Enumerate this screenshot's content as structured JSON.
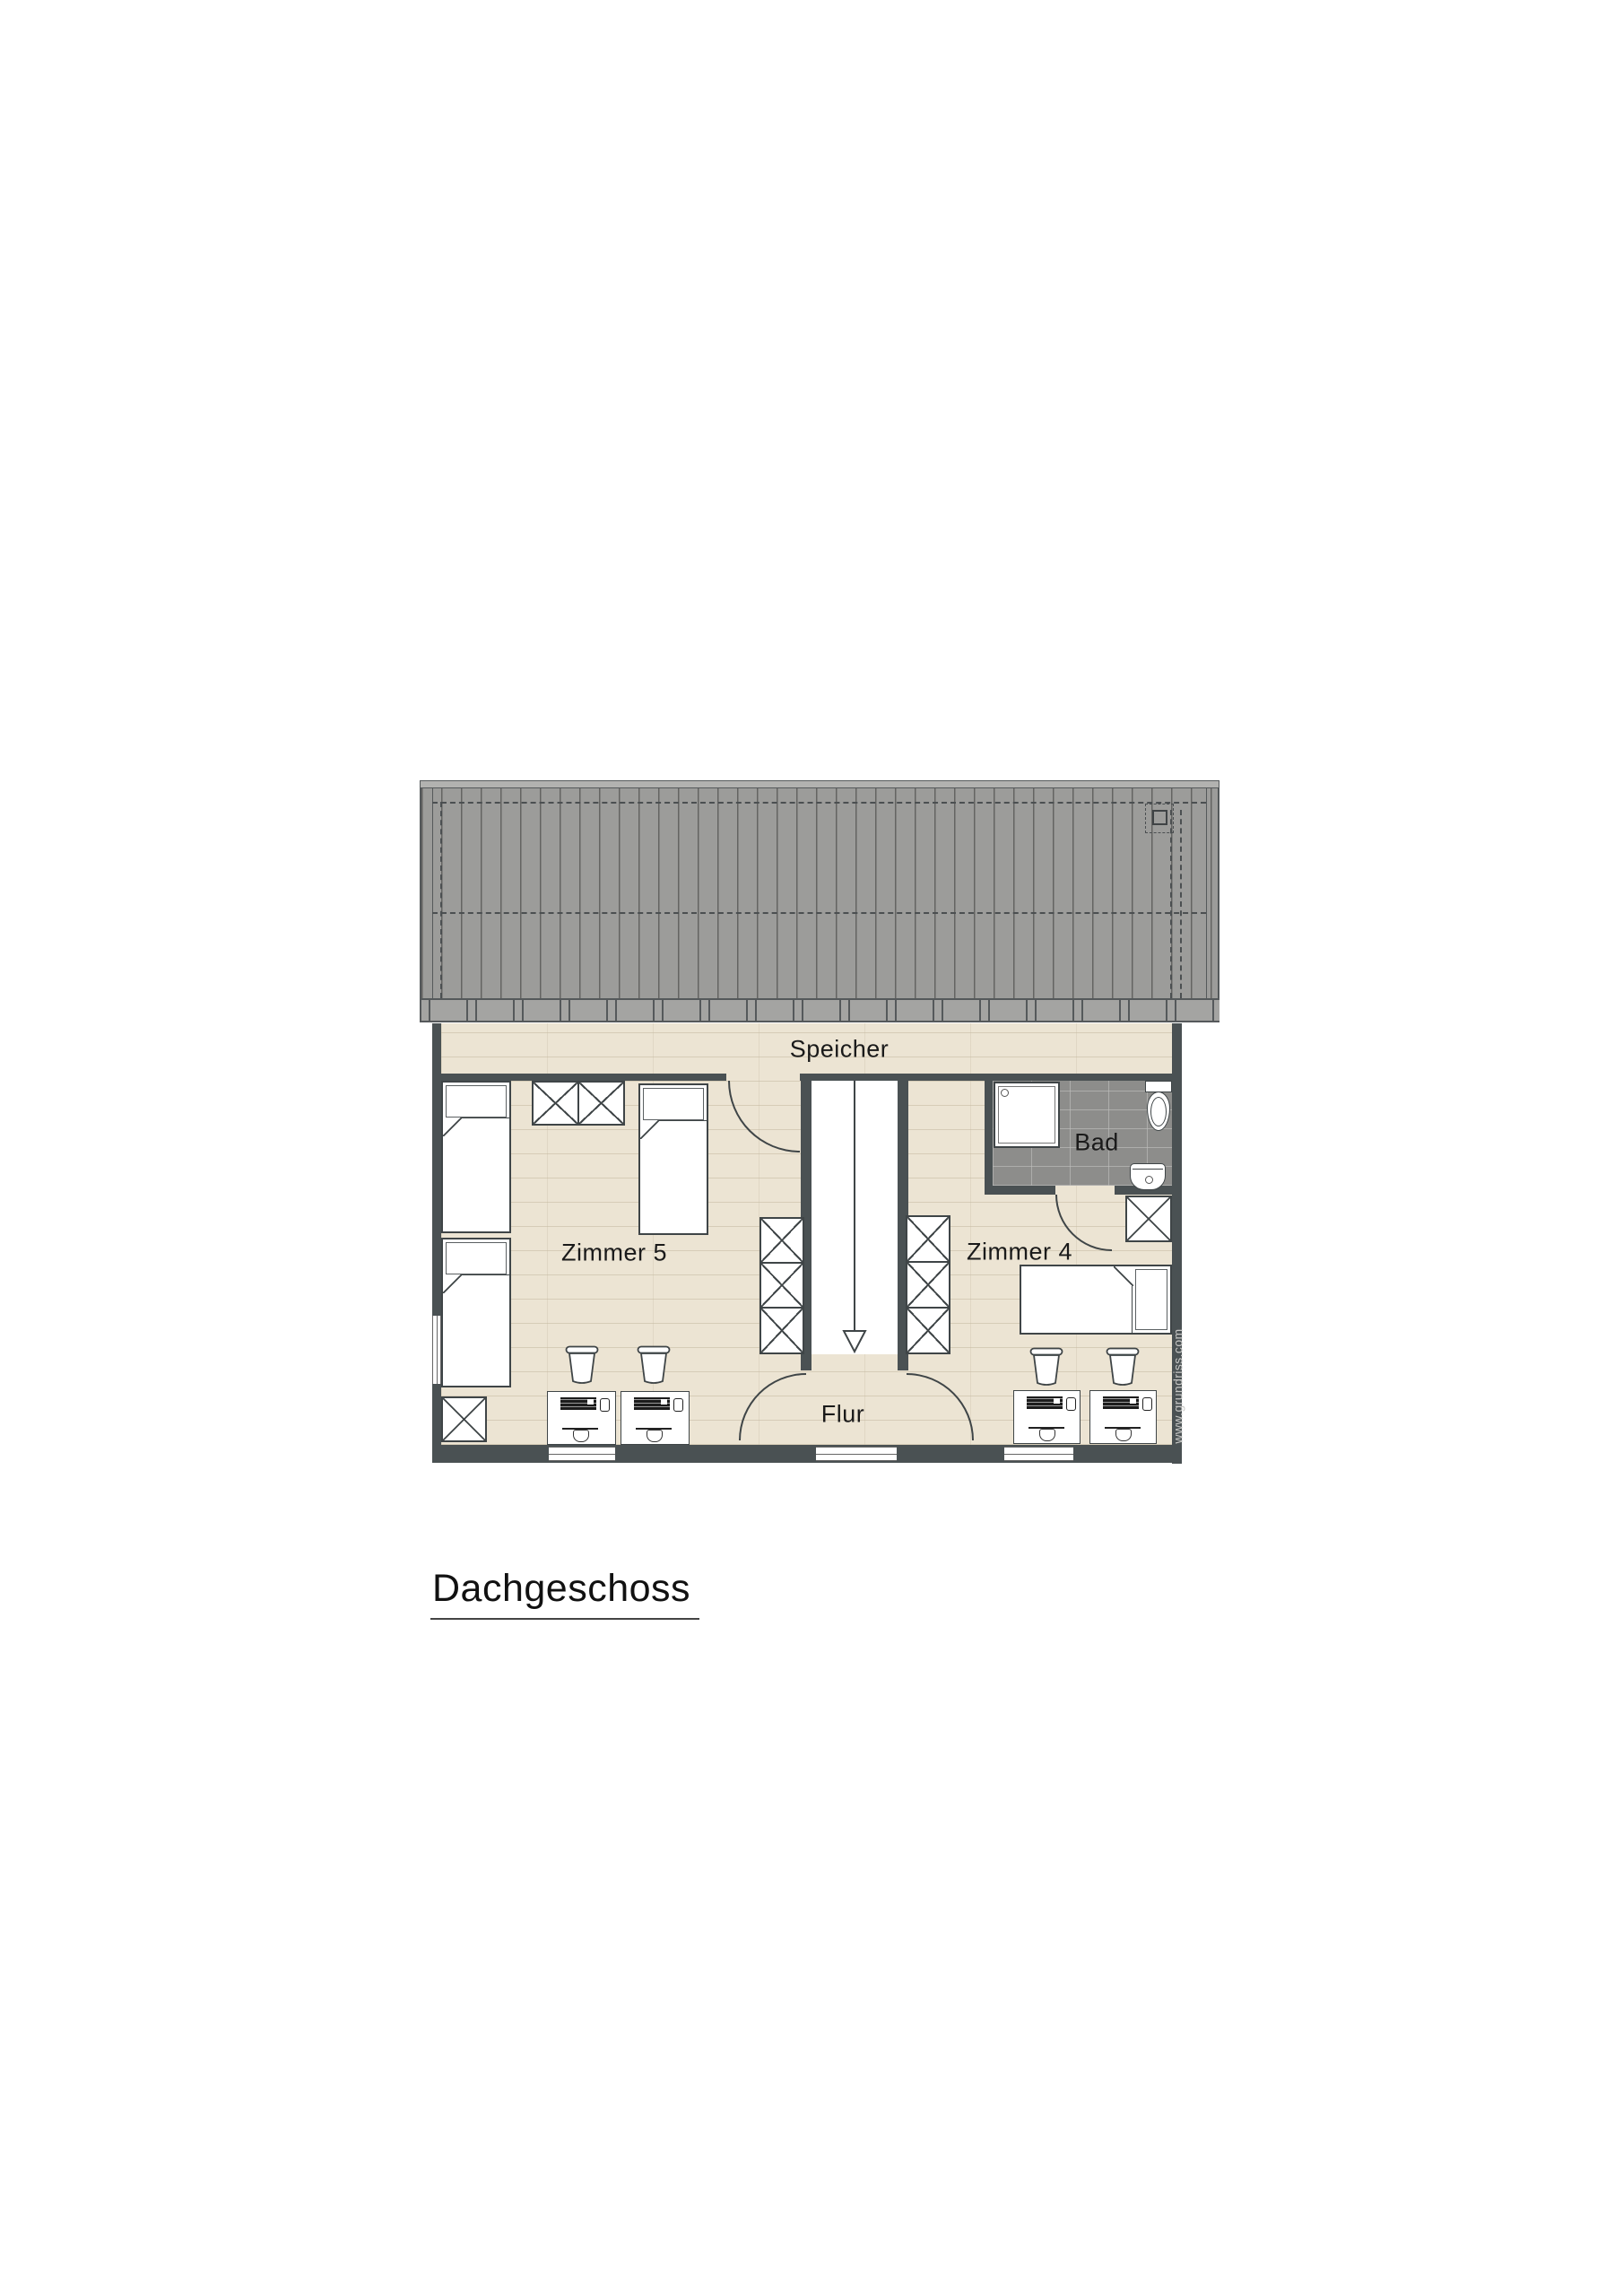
{
  "plan": {
    "floor_title": "Dachgeschoss",
    "rooms": {
      "speicher": "Speicher",
      "zimmer5": "Zimmer 5",
      "zimmer4": "Zimmer 4",
      "bad": "Bad",
      "flur": "Flur"
    },
    "watermark": "www.grundriss.com",
    "stairs_direction": "down"
  },
  "colors": {
    "wall": "#4a5153",
    "floor_wood": "#ece4d3",
    "roof": "#9c9c9a",
    "roof_line": "#55595b",
    "tile": "#8d8d8b",
    "outline": "#3f4547",
    "text": "#1a1a1a",
    "watermark_color": "#c6c6c4"
  }
}
